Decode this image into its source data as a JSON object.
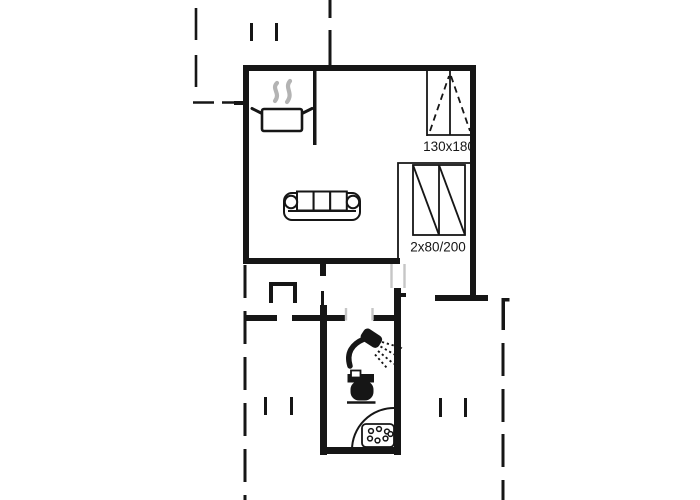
{
  "document": {
    "kind": "holiday-home floor plan drawing",
    "background": "#ffffff"
  },
  "colors": {
    "wall_line": "#161616",
    "steam_gray": "#b3b3b3",
    "door_jamb_gray": "#c6c6c6"
  },
  "labels": {
    "window_size": "130x180",
    "wardrobe_size": "2x80/200"
  },
  "icons": [
    {
      "name": "cooking-pot-icon",
      "meaning": "kitchen / stove area"
    },
    {
      "name": "steam-icon",
      "meaning": "steam above cooking pot"
    },
    {
      "name": "sofa-icon",
      "meaning": "living room seating"
    },
    {
      "name": "wardrobe-icon",
      "meaning": "double wardrobe 2x80/200"
    },
    {
      "name": "window-icon",
      "meaning": "openable window 130x180"
    },
    {
      "name": "shower-icon",
      "meaning": "shower head in bathroom"
    },
    {
      "name": "toilet-icon",
      "meaning": "toilet in bathroom"
    },
    {
      "name": "shower-tray-icon",
      "meaning": "corner shower tray with drain"
    }
  ]
}
